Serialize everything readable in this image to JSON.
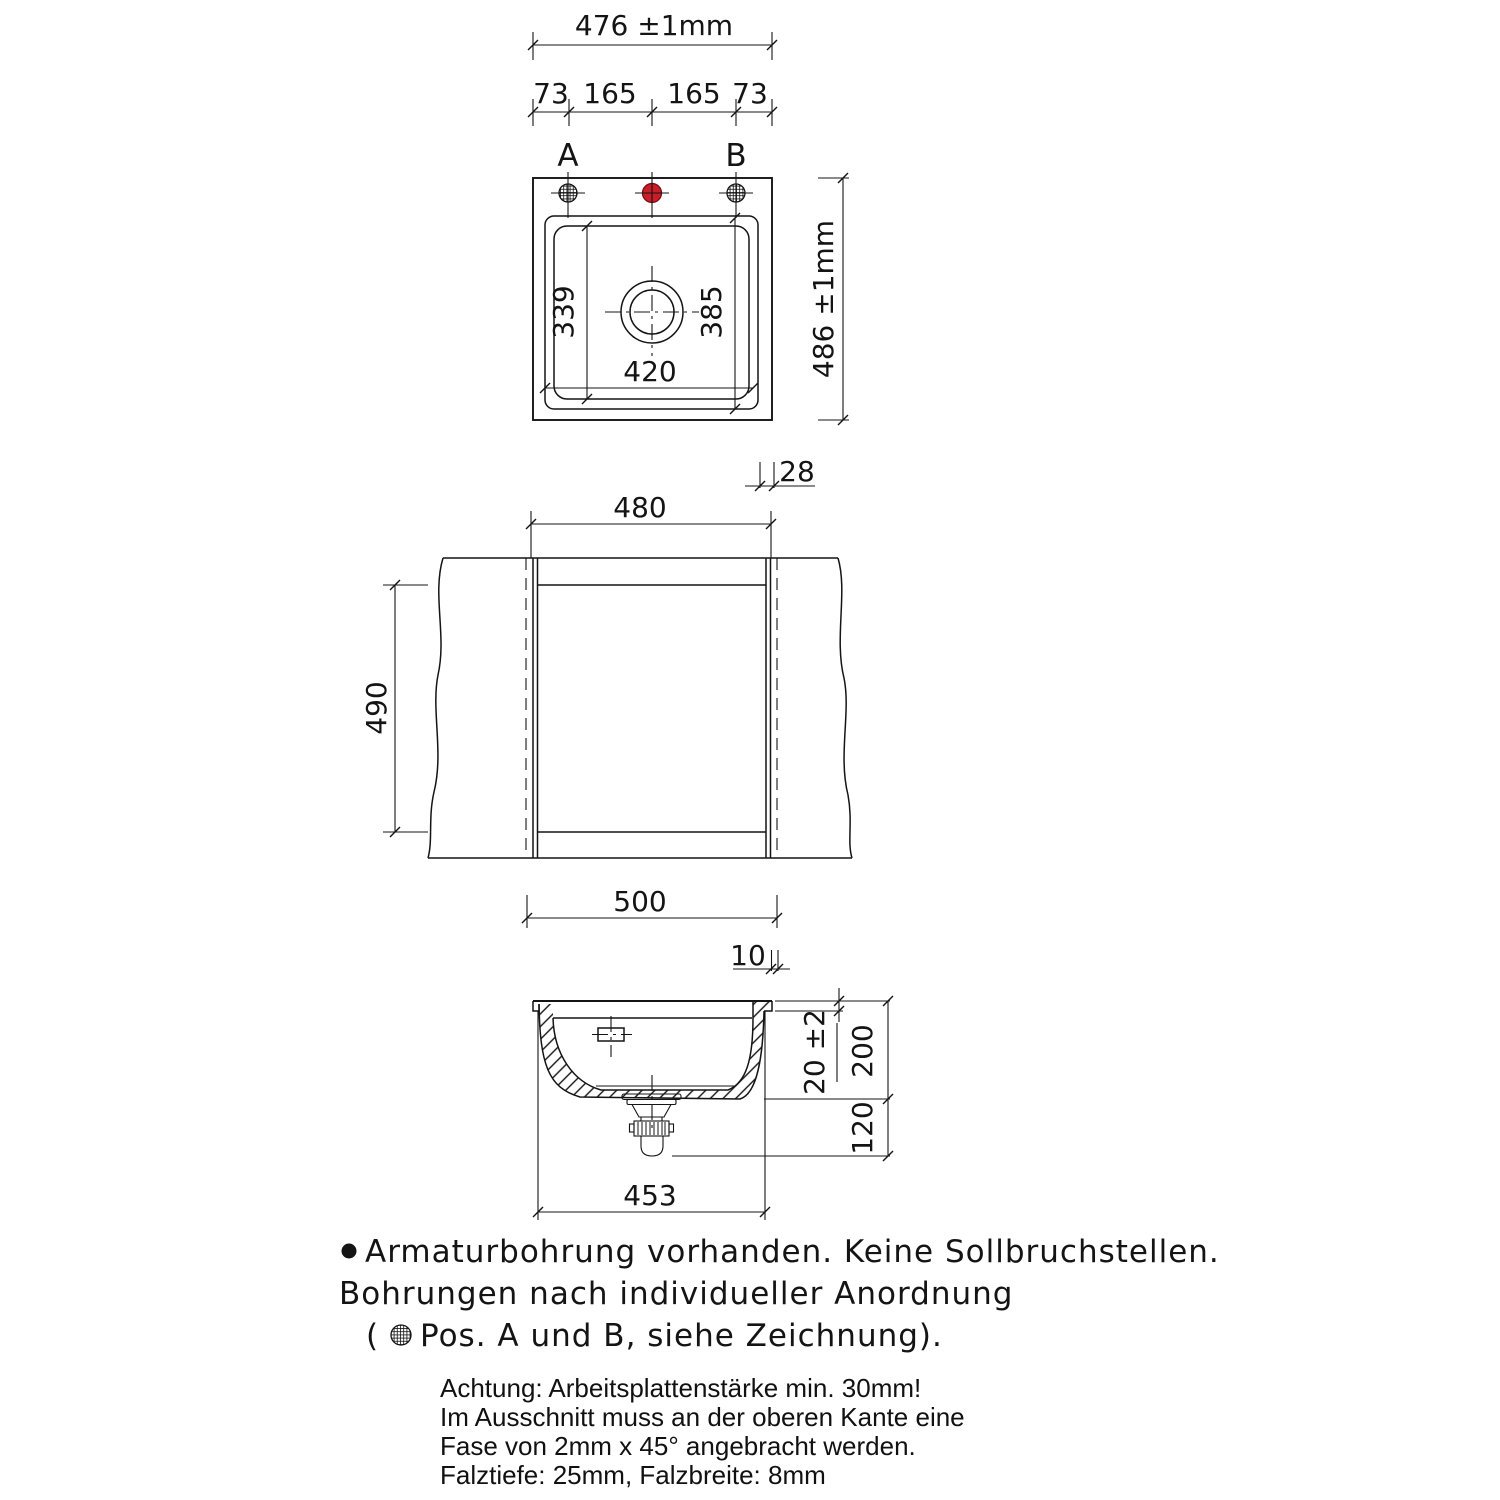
{
  "top_view": {
    "width_dim": "476 ±1mm",
    "offsets": [
      "73",
      "165",
      "165",
      "73"
    ],
    "hole_a_label": "A",
    "hole_b_label": "B",
    "inner_depth_dim": "339",
    "outer_depth_dim": "385",
    "bowl_width_dim": "420",
    "depth_dim": "486 ±1mm",
    "rim_width_dim": "28"
  },
  "cutout_view": {
    "cutout_width_dim": "480",
    "cutout_depth_dim": "490",
    "outer_width_dim": "500"
  },
  "section_view": {
    "edge_gap_dim": "10",
    "rim_height_dim": "20 ±2",
    "bowl_depth_dim": "200",
    "drain_height_dim": "120",
    "body_width_dim": "453"
  },
  "notes": {
    "line1": "Armaturbohrung vorhanden. Keine Sollbruchstellen.",
    "line2": "Bohrungen nach individueller Anordnung",
    "line3_open": "(",
    "line3_rest": "Pos. A und B, siehe Zeichnung)."
  },
  "warning": {
    "line1": "Achtung: Arbeitsplattenstärke min. 30mm!",
    "line2": "Im Ausschnitt muss an der oberen Kante eine",
    "line3": "Fase von 2mm x 45° angebracht werden.",
    "line4": "Falztiefe: 25mm, Falzbreite: 8mm"
  },
  "colors": {
    "line": "#141414",
    "accent_red": "#c81e27"
  }
}
